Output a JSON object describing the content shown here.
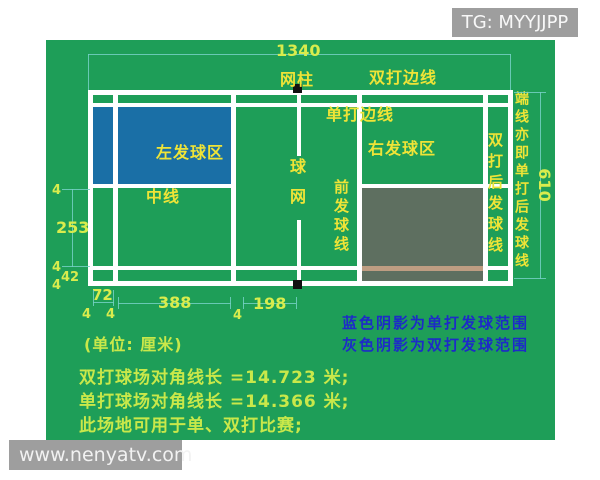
{
  "watermarks": {
    "telegram": "TG: MYYJJPP",
    "website": "www.nenyatv.com"
  },
  "court": {
    "labels": {
      "net_post": "网柱",
      "doubles_sideline": "双打边线",
      "singles_sideline": "单打边线",
      "left_service_area": "左发球区",
      "right_service_area": "右发球区",
      "center_line": "中线",
      "net": "球网",
      "front_service_line": "前发球线",
      "doubles_back_service_line": "双打后发球线",
      "end_line_alias": "端线亦即单打后发球线"
    },
    "dimensions_cm": {
      "total_length": "1340",
      "total_width": "610",
      "service_area_width": "253",
      "sideline_gap": "42",
      "back_service_gap": "72",
      "service_area_length": "388",
      "short_service_distance": "198",
      "line_width": "4"
    }
  },
  "notes": {
    "unit": "(单位: 厘米)",
    "blue_shade": "蓝色阴影为单打发球范围",
    "gray_shade": "灰色阴影为双打发球范围",
    "doubles_diagonal": "双打球场对角线长 =14.723 米;",
    "singles_diagonal": "单打球场对角线长 =14.366 米;",
    "usage": "此场地可用于单、双打比赛;"
  },
  "colors": {
    "field_green": "#1E9E58",
    "court_line": "#FFFFFF",
    "singles_service_shade": "#1A6FA6",
    "doubles_service_shade": "#5E6F60",
    "shaded_sideline_over_grey": "#BE9D82",
    "dimension_line": "#76D0C4",
    "dimension_text": "#D9EC4D",
    "label_text": "#EFE437",
    "note_text": "#1D2BC8",
    "bottom_text": "#C9E84A",
    "watermark_bg": "#9E9E9E"
  }
}
